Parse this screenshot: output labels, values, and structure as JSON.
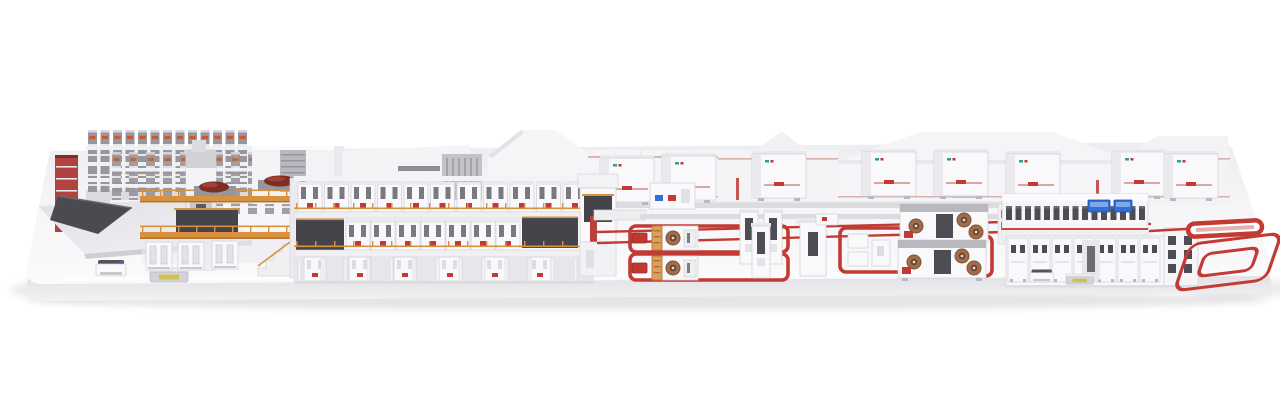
{
  "scene": {
    "description": "photorealistic 3d render of a complete industrial battery-electrode production line standing on a white rounded display plinth, white background, no visible text",
    "sections": [
      {
        "name": "storage-rack-towers"
      },
      {
        "name": "red-stair-tower"
      },
      {
        "name": "prep-table-and-feeder"
      },
      {
        "name": "coating-mezzanine"
      },
      {
        "name": "two-story-oven-line"
      },
      {
        "name": "line-end-tower"
      },
      {
        "name": "floor-logistics-lanes"
      },
      {
        "name": "slitting-cell-loops"
      },
      {
        "name": "winding-cell-loops"
      },
      {
        "name": "inspection-line"
      },
      {
        "name": "red-conveyor-bar"
      },
      {
        "name": "red-conveyor-racetrack"
      },
      {
        "name": "agv-shuttles"
      },
      {
        "name": "backdrop-factory-halls"
      }
    ]
  },
  "palette": {
    "bg": "#ffffff",
    "platform_top": "#f3f3f6",
    "platform_face": "#e6e6ea",
    "platform_front_light": "#fafafb",
    "shadow": "#cfcfd4",
    "box_white": "#f9f8fa",
    "box_edge": "#d3d2d8",
    "panel_shade": "#eae9ed",
    "steel": "#b9b8be",
    "steel_dark": "#97969e",
    "charcoal": "#45444b",
    "window_dark": "#4e4d54",
    "accent_red": "#c23a33",
    "red_bright": "#d14a41",
    "dark_red": "#7e2d24",
    "maroon": "#b2423d",
    "orange": "#d8913f",
    "copper": "#a26b49",
    "copper_dark": "#5d4434",
    "copper_light": "#e8d9c9",
    "hmi_blue": "#2f6fd6",
    "hmi_blue_light": "#7fa8ea",
    "agv_yellow": "#cfc14f",
    "teal_logo": "#2aa198",
    "floor_line_pale": "#d8b0ad",
    "conveyor_gray": "#dcdbdf"
  },
  "layout": {
    "storage_rack_columns_back": 13,
    "storage_rack_columns_front": 11,
    "oven_top_modules": 11,
    "oven_mid_modules": 7,
    "oven_ground_columns": 13,
    "oven_ground_cabinets": 6,
    "railing_posts_upper": 16,
    "railing_posts_mid": 16,
    "mezz_posts_upper": 9,
    "mezz_posts_mid": 9,
    "right_back_windows": 15,
    "right_front_modules": 7
  }
}
